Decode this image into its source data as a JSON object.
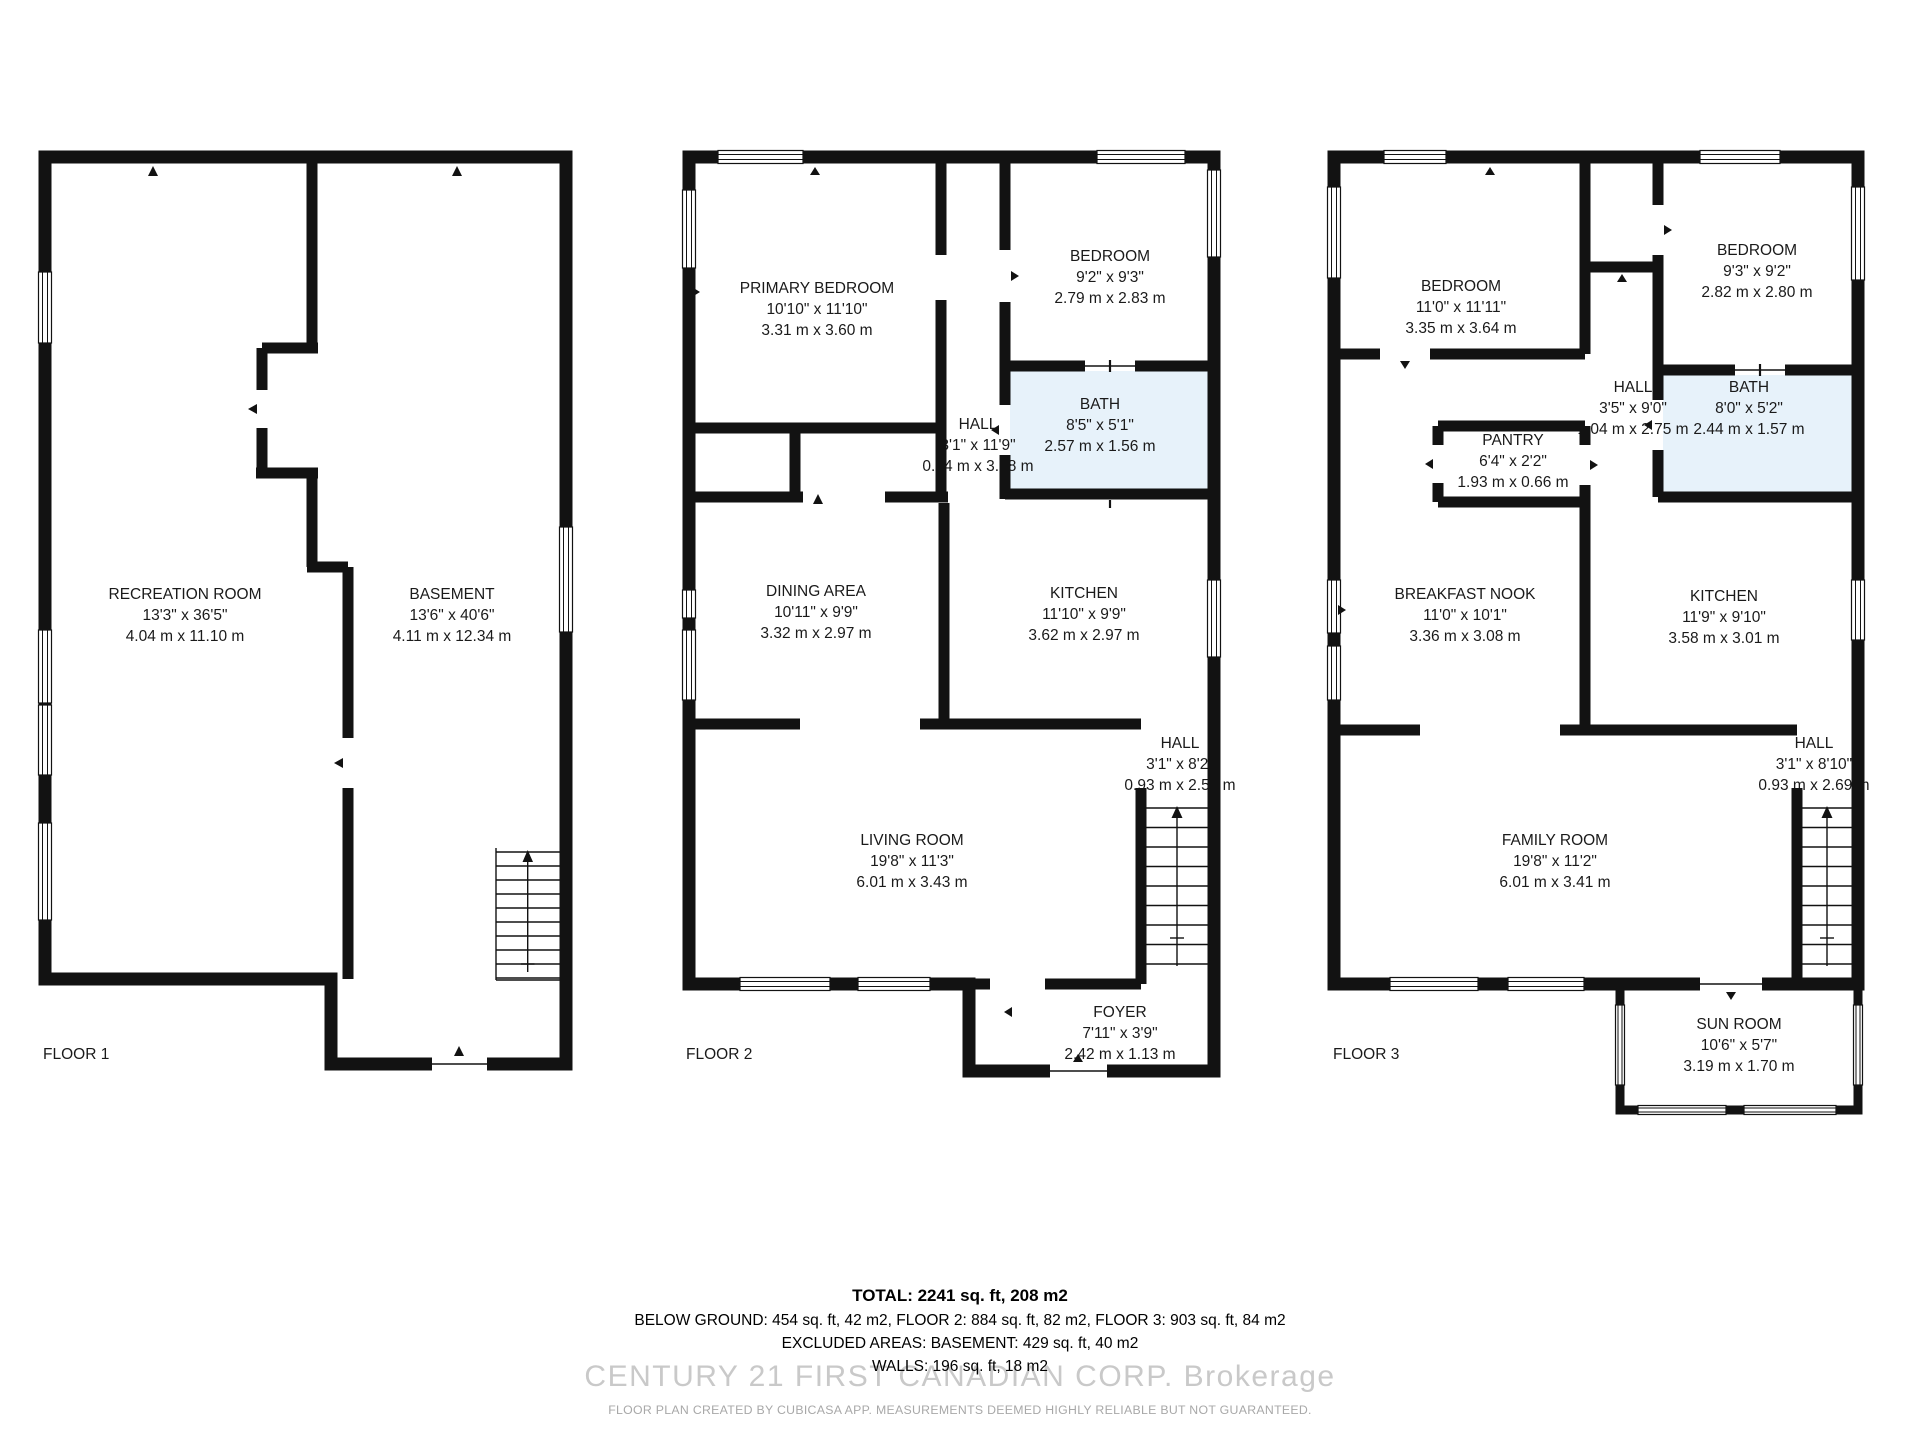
{
  "colors": {
    "wall": "#121212",
    "bath_fill": "#e7f2fa",
    "label_text": "#1a1a1a",
    "watermark_text": "#c9c9c9",
    "disclaimer_text": "#a8a8a8"
  },
  "floors": [
    {
      "label": "FLOOR 1",
      "rooms": [
        {
          "id": "recreation-room",
          "name": "RECREATION ROOM",
          "imperial": "13'3\" x 36'5\"",
          "metric": "4.04 m x 11.10 m"
        },
        {
          "id": "basement",
          "name": "BASEMENT",
          "imperial": "13'6\" x 40'6\"",
          "metric": "4.11 m x 12.34 m"
        }
      ]
    },
    {
      "label": "FLOOR 2",
      "rooms": [
        {
          "id": "primary-bedroom",
          "name": "PRIMARY BEDROOM",
          "imperial": "10'10\" x 11'10\"",
          "metric": "3.31 m x 3.60 m"
        },
        {
          "id": "bedroom",
          "name": "BEDROOM",
          "imperial": "9'2\" x 9'3\"",
          "metric": "2.79 m x 2.83 m"
        },
        {
          "id": "hall-upper",
          "name": "HALL",
          "imperial": "3'1\" x 11'9\"",
          "metric": "0.94 m x 3.58 m"
        },
        {
          "id": "bath",
          "name": "BATH",
          "imperial": "8'5\" x 5'1\"",
          "metric": "2.57 m x 1.56 m"
        },
        {
          "id": "dining-area",
          "name": "DINING AREA",
          "imperial": "10'11\" x 9'9\"",
          "metric": "3.32 m x 2.97 m"
        },
        {
          "id": "kitchen",
          "name": "KITCHEN",
          "imperial": "11'10\" x 9'9\"",
          "metric": "3.62 m x 2.97 m"
        },
        {
          "id": "hall-stairs",
          "name": "HALL",
          "imperial": "3'1\" x 8'2\"",
          "metric": "0.93 m x 2.50 m"
        },
        {
          "id": "living-room",
          "name": "LIVING ROOM",
          "imperial": "19'8\" x 11'3\"",
          "metric": "6.01 m x 3.43 m"
        },
        {
          "id": "foyer",
          "name": "FOYER",
          "imperial": "7'11\" x 3'9\"",
          "metric": "2.42 m x 1.13 m"
        }
      ]
    },
    {
      "label": "FLOOR 3",
      "rooms": [
        {
          "id": "bedroom-left",
          "name": "BEDROOM",
          "imperial": "11'0\" x 11'11\"",
          "metric": "3.35 m x 3.64 m"
        },
        {
          "id": "bedroom-right",
          "name": "BEDROOM",
          "imperial": "9'3\" x 9'2\"",
          "metric": "2.82 m x 2.80 m"
        },
        {
          "id": "hall-upper",
          "name": "HALL",
          "imperial": "3'5\" x 9'0\"",
          "metric": "1.04 m x 2.75 m"
        },
        {
          "id": "bath",
          "name": "BATH",
          "imperial": "8'0\" x 5'2\"",
          "metric": "2.44 m x 1.57 m"
        },
        {
          "id": "pantry",
          "name": "PANTRY",
          "imperial": "6'4\" x 2'2\"",
          "metric": "1.93 m x 0.66 m"
        },
        {
          "id": "breakfast-nook",
          "name": "BREAKFAST NOOK",
          "imperial": "11'0\" x 10'1\"",
          "metric": "3.36 m x 3.08 m"
        },
        {
          "id": "kitchen",
          "name": "KITCHEN",
          "imperial": "11'9\" x 9'10\"",
          "metric": "3.58 m x 3.01 m"
        },
        {
          "id": "hall-stairs",
          "name": "HALL",
          "imperial": "3'1\" x 8'10\"",
          "metric": "0.93 m x 2.69 m"
        },
        {
          "id": "family-room",
          "name": "FAMILY ROOM",
          "imperial": "19'8\" x 11'2\"",
          "metric": "6.01 m x 3.41 m"
        },
        {
          "id": "sun-room",
          "name": "SUN ROOM",
          "imperial": "10'6\" x 5'7\"",
          "metric": "3.19 m x 1.70 m"
        }
      ]
    }
  ],
  "summary": {
    "total": "TOTAL: 2241 sq. ft, 208 m2",
    "by_floor": "BELOW GROUND: 454 sq. ft, 42 m2, FLOOR 2: 884 sq. ft, 82 m2, FLOOR 3: 903 sq. ft, 84 m2",
    "excluded": "EXCLUDED AREAS: BASEMENT: 429 sq. ft, 40 m2",
    "walls": "WALLS: 196 sq. ft, 18 m2"
  },
  "watermark": "CENTURY 21 FIRST CANADIAN CORP.  Brokerage",
  "disclaimer": "FLOOR PLAN CREATED BY CUBICASA APP. MEASUREMENTS DEEMED HIGHLY RELIABLE BUT NOT GUARANTEED."
}
